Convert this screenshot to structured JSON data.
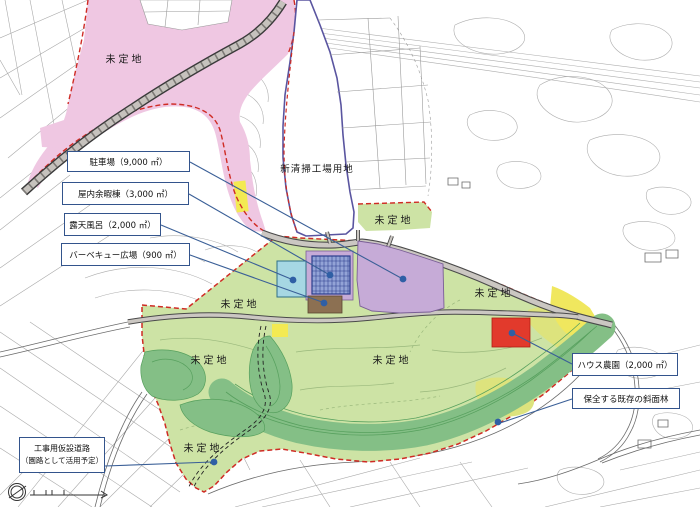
{
  "area_labels": {
    "undetermined": "未定地",
    "new_cleaning_plant_site": "新清掃工場用地"
  },
  "callouts": {
    "parking": "駐車場（9,000 ㎡）",
    "indoor_leisure": "屋内余暇棟（3,000 ㎡）",
    "open_air_bath": "露天風呂（2,000 ㎡）",
    "bbq_plaza": "バーベキュー広場（900 ㎡）",
    "house_farm": "ハウス農園（2,000 ㎡）",
    "preserved_slope_forest": "保全する既存の斜面林",
    "construction_road_line1": "工事用仮設道路",
    "construction_road_line2": "（園路として活用予定）"
  },
  "colors": {
    "undetermined_zone_pink": "#efc7e2",
    "planned_area_green": "#cde3a5",
    "slope_forest_green": "#84bf86",
    "farmland_olive": "#dde37d",
    "highlight_yellow": "#f3ea52",
    "parking_purple": "#c6abd7",
    "bath_cyan": "#a6d7e3",
    "bbq_brown": "#8c7052",
    "house_farm_red": "#e23a2c",
    "boundary_red": "#cf2b24",
    "annotation_navy": "#33548c",
    "road_grey": "#cbc7c2"
  }
}
